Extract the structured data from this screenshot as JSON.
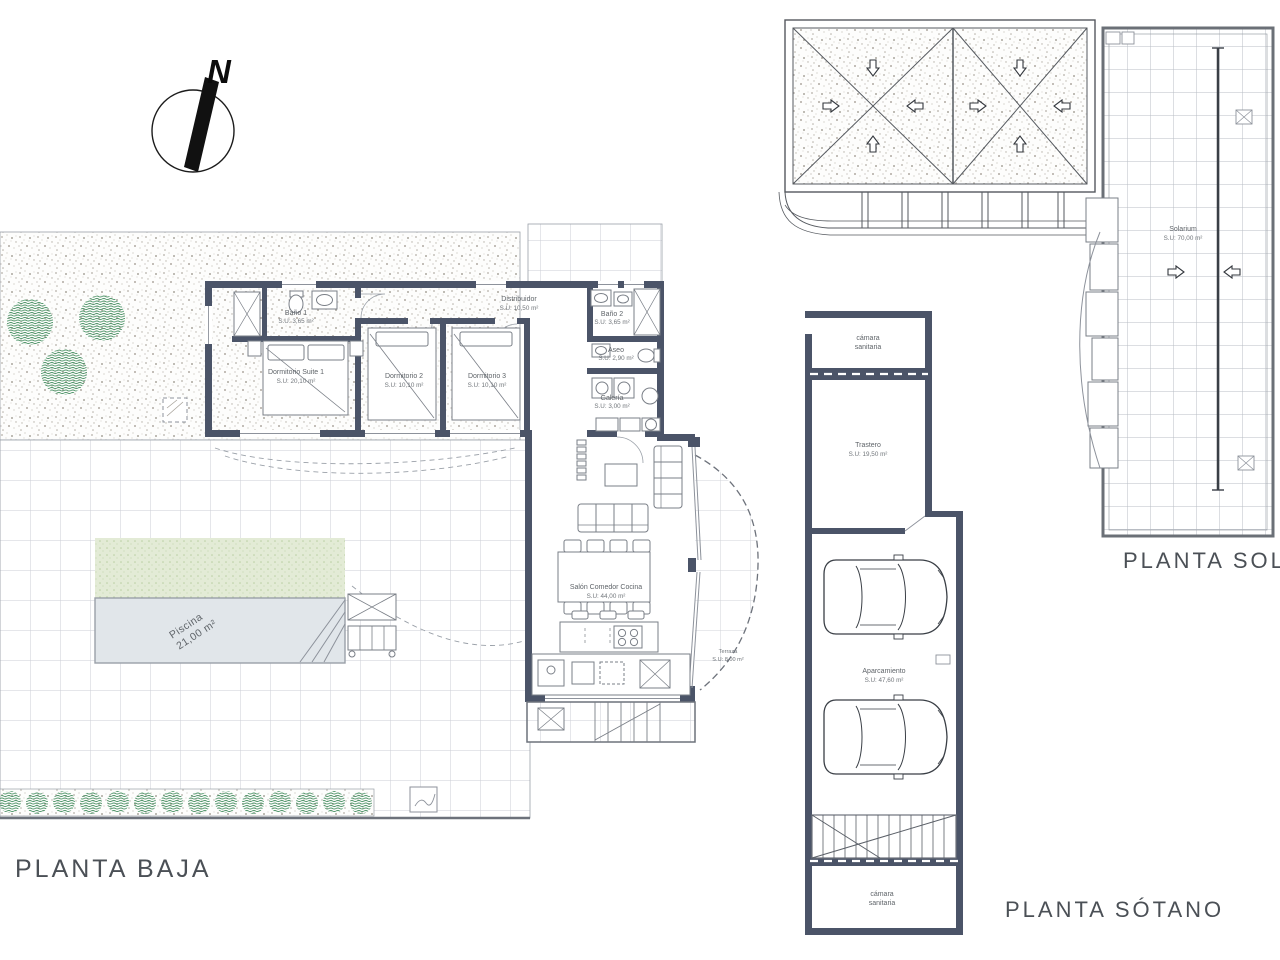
{
  "colors": {
    "wall": "#4b5468",
    "line_gray": "#8d929b",
    "tile_line": "#cbced5",
    "text_gray": "#5f6469",
    "title_gray": "#4b5056",
    "bush_green": "#4e9468",
    "lawn_green": "#e3ebd6",
    "pool_blue": "#e1e6ea",
    "stipple_gray": "#b4afa7"
  },
  "titles": {
    "baja": "PLANTA BAJA",
    "sotano": "PLANTA SÓTANO",
    "solarium": "PLANTA SOLARIUM"
  },
  "compass": {
    "north": "N"
  },
  "baja_rooms": {
    "suite": {
      "name": "Dormitorio Suite 1",
      "area": "S.U: 20,10 m²"
    },
    "bano1": {
      "name": "Baño 1",
      "area": "S.U: 3,65 m²"
    },
    "dorm2": {
      "name": "Dormitorio 2",
      "area": "S.U: 10,10 m²"
    },
    "dorm3": {
      "name": "Dormitorio 3",
      "area": "S.U: 10,10 m²"
    },
    "distribuidor": {
      "name": "Distribuidor",
      "area": "S.U: 10,50 m²"
    },
    "bano2": {
      "name": "Baño 2",
      "area": "S.U: 3,65 m²"
    },
    "aseo": {
      "name": "Aseo",
      "area": "S.U: 2,90 m²"
    },
    "galeria": {
      "name": "Galería",
      "area": "S.U: 3,00 m²"
    },
    "salon": {
      "name": "Salón Comedor Cocina",
      "area": "S.U: 44,00 m²"
    },
    "terraza": {
      "name": "Terraza",
      "area": "S.U: 8,00 m²"
    },
    "piscina": {
      "name": "Piscina",
      "area": "21,00 m²"
    }
  },
  "sotano_rooms": {
    "camara_top": {
      "line1": "cámara",
      "line2": "sanitaria"
    },
    "trastero": {
      "name": "Trastero",
      "area": "S.U: 19,50 m²"
    },
    "aparcamiento": {
      "name": "Aparcamiento",
      "area": "S.U: 47,60 m²"
    },
    "camara_bottom": {
      "line1": "cámara",
      "line2": "sanitaria"
    }
  },
  "solarium_rooms": {
    "solarium": {
      "name": "Solarium",
      "area": "S.U: 70,00 m²"
    }
  }
}
